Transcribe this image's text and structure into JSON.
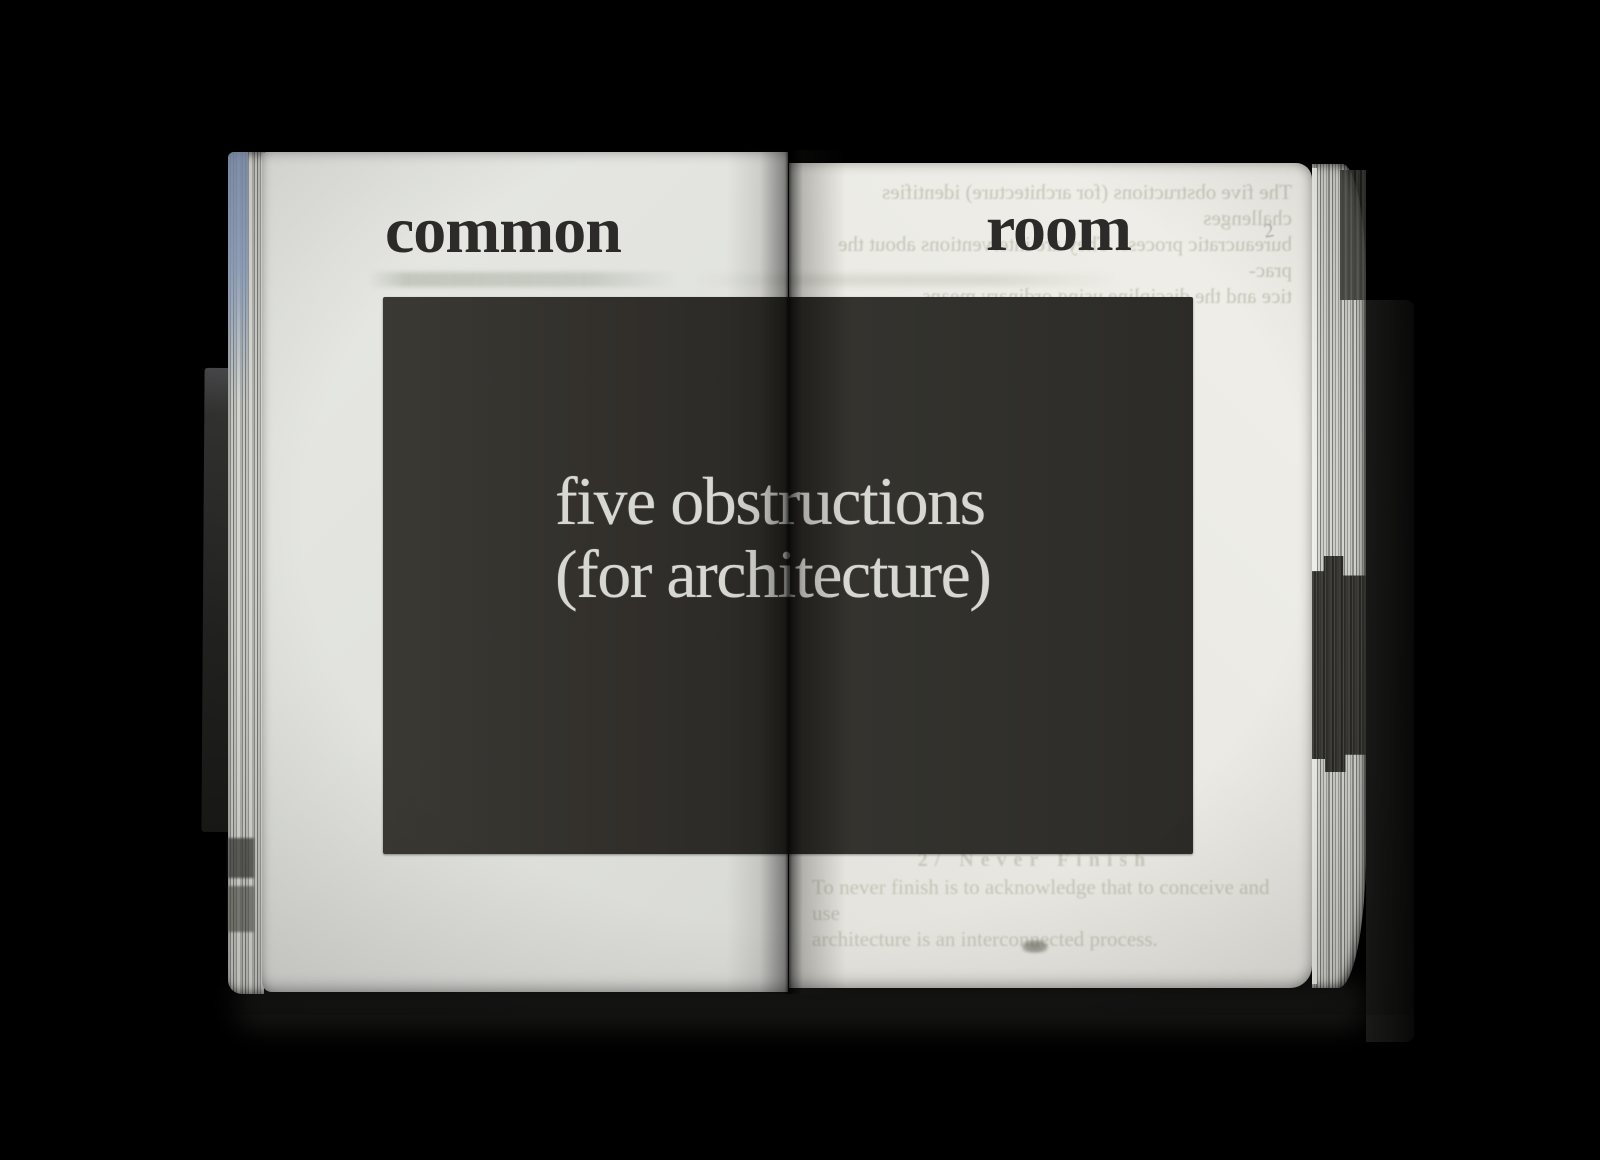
{
  "book": {
    "left_page": {
      "header": "common"
    },
    "right_page": {
      "header": "room",
      "showthrough_top": {
        "lines": [
          "The five obstructions (for architecture) identifies challenges",
          "bureaucratic process. They are interventions about the prac-",
          "tice and the discipline using ordinary means."
        ],
        "margin_mark": "2"
      },
      "showthrough_bottom": {
        "heading": "2/ Never Finish",
        "lines": [
          "To never finish is to acknowledge that to conceive and use",
          "architecture is an interconnected process."
        ]
      }
    },
    "plate": {
      "lines": [
        "five obstructions",
        "(for architecture)"
      ]
    },
    "colors": {
      "background": "#000000",
      "paper_left": "#e1e2de",
      "paper_right": "#ebeae4",
      "plate": "#302f2b",
      "plate_text": "#d7d8d2",
      "ink": "#2c2b29",
      "fore_edge_blue": "#8399ba"
    }
  }
}
